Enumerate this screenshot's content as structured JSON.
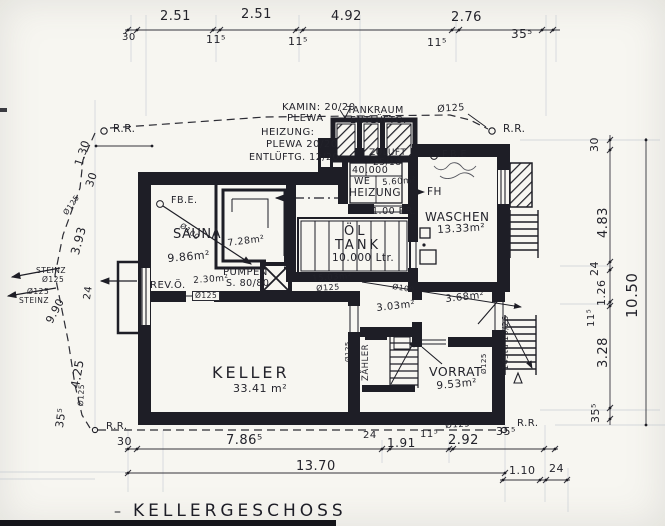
{
  "title": {
    "text": "KELLERGESCHOSS"
  },
  "annotations": [
    {
      "n": "dim-top-30",
      "t": "30",
      "x": 122,
      "y": 33,
      "s": 10
    },
    {
      "n": "dim-top-251-a",
      "t": "2.51",
      "x": 160,
      "y": 10,
      "s": 13
    },
    {
      "n": "dim-top-115-a",
      "t": "11⁵",
      "x": 206,
      "y": 34,
      "s": 11
    },
    {
      "n": "dim-top-251-b",
      "t": "2.51",
      "x": 241,
      "y": 8,
      "s": 13
    },
    {
      "n": "dim-top-115-b",
      "t": "11⁵",
      "x": 288,
      "y": 36,
      "s": 11
    },
    {
      "n": "dim-top-492",
      "t": "4.92",
      "x": 331,
      "y": 10,
      "s": 13
    },
    {
      "n": "dim-top-115-c",
      "t": "11⁵",
      "x": 427,
      "y": 37,
      "s": 11
    },
    {
      "n": "dim-top-276",
      "t": "2.76",
      "x": 451,
      "y": 11,
      "s": 13
    },
    {
      "n": "dim-top-355",
      "t": "35⁵",
      "x": 511,
      "y": 28,
      "s": 12
    },
    {
      "n": "rr-top-left",
      "t": "R.R.",
      "x": 113,
      "y": 124,
      "s": 10.5
    },
    {
      "n": "label-kamin",
      "t": "KAMIN: 20/20",
      "x": 282,
      "y": 103,
      "s": 10
    },
    {
      "n": "label-kamin-plewa",
      "t": "PLEWA",
      "x": 287,
      "y": 114,
      "s": 10
    },
    {
      "n": "label-heizung-schacht",
      "t": "HEIZUNG:",
      "x": 261,
      "y": 128,
      "s": 10
    },
    {
      "n": "label-heizung-plewa",
      "t": "PLEWA 20/20",
      "x": 266,
      "y": 140,
      "s": 10
    },
    {
      "n": "label-entlueftg",
      "t": "ENTLÜFTG. 12/20",
      "x": 249,
      "y": 153,
      "s": 9.5
    },
    {
      "n": "label-tankraum",
      "t": "TANKRAUM",
      "x": 347,
      "y": 106,
      "s": 9.5
    },
    {
      "n": "label-tankraum-entlueftg",
      "t": "ENTLÜFTG.",
      "x": 350,
      "y": 116,
      "s": 9.5
    },
    {
      "n": "label-o125-top",
      "t": "Ø125",
      "x": 437,
      "y": 105,
      "s": 9.5,
      "r": -4
    },
    {
      "n": "rr-top-right",
      "t": "R.R.",
      "x": 503,
      "y": 124,
      "s": 10.5
    },
    {
      "n": "label-zuluft",
      "t": "ZULUFT",
      "x": 369,
      "y": 149,
      "s": 9
    },
    {
      "n": "label-zuluft-size",
      "t": "25/18",
      "x": 373,
      "y": 159,
      "s": 9
    },
    {
      "n": "label-boiler-40000",
      "t": "40.000",
      "x": 352,
      "y": 166,
      "s": 9.5
    },
    {
      "n": "label-boiler-we",
      "t": "WE",
      "x": 354,
      "y": 177,
      "s": 9.5
    },
    {
      "n": "room-heizung",
      "t": "HEIZUNG",
      "x": 349,
      "y": 188,
      "s": 10.5
    },
    {
      "n": "area-heizung",
      "t": "5.60m²",
      "x": 382,
      "y": 179,
      "s": 8.5,
      "r": -4
    },
    {
      "n": "label-fh",
      "t": "FH",
      "x": 427,
      "y": 187,
      "s": 10.5
    },
    {
      "n": "label-door-100",
      "t": "1.00 BR.",
      "x": 372,
      "y": 207,
      "s": 9.5
    },
    {
      "n": "room-waschen",
      "t": "WASCHEN",
      "x": 425,
      "y": 211,
      "s": 12
    },
    {
      "n": "area-waschen",
      "t": "13.33m²",
      "x": 437,
      "y": 225,
      "s": 10.5,
      "r": -3
    },
    {
      "n": "label-fbe-waschen",
      "t": "F.B.E",
      "x": 442,
      "y": 150,
      "s": 9.5
    },
    {
      "n": "label-fbe-sauna",
      "t": "FB.E.",
      "x": 171,
      "y": 196,
      "s": 9.5
    },
    {
      "n": "label-o100-sauna",
      "t": "Ø100",
      "x": 183,
      "y": 222,
      "s": 7.5,
      "r": 37
    },
    {
      "n": "room-sauna",
      "t": "SAUNA",
      "x": 173,
      "y": 228,
      "s": 13
    },
    {
      "n": "area-sauna",
      "t": "9.86m²",
      "x": 167,
      "y": 253,
      "s": 11,
      "r": -5
    },
    {
      "n": "area-sauna-kabine",
      "t": "7.28m²",
      "x": 227,
      "y": 239,
      "s": 9.5,
      "r": -7
    },
    {
      "n": "room-pumpen",
      "t": "PUMPEN",
      "x": 223,
      "y": 268,
      "s": 10
    },
    {
      "n": "label-revoe",
      "t": "REV.Ö.",
      "x": 150,
      "y": 281,
      "s": 10
    },
    {
      "n": "area-corridor",
      "t": "2.30m²",
      "x": 193,
      "y": 277,
      "s": 9,
      "r": -4
    },
    {
      "n": "label-schacht",
      "t": "S. 80/80",
      "x": 226,
      "y": 279,
      "s": 9.5
    },
    {
      "n": "label-o125-corridor",
      "t": "Ø125",
      "x": 192,
      "y": 291,
      "s": 7.5,
      "c": "box"
    },
    {
      "n": "room-oel",
      "t": "ÖL",
      "x": 344,
      "y": 225,
      "s": 13,
      "c": "sp"
    },
    {
      "n": "room-tank",
      "t": "TANK",
      "x": 335,
      "y": 239,
      "s": 13,
      "c": "sp"
    },
    {
      "n": "label-tank-litres",
      "t": "10.000 Ltr.",
      "x": 332,
      "y": 253,
      "s": 10.5
    },
    {
      "n": "area-tank",
      "t": "15.03m²",
      "x": 312,
      "y": 275,
      "s": 8.5,
      "r": -4
    },
    {
      "n": "label-o125-tank",
      "t": "Ø125",
      "x": 316,
      "y": 285,
      "s": 8,
      "r": -4
    },
    {
      "n": "room-keller",
      "t": "KELLER",
      "x": 212,
      "y": 365,
      "s": 16,
      "c": "sp"
    },
    {
      "n": "area-keller",
      "t": "33.41 m²",
      "x": 233,
      "y": 383,
      "s": 11
    },
    {
      "n": "area-303",
      "t": "3.03m²",
      "x": 376,
      "y": 304,
      "s": 10,
      "r": -6
    },
    {
      "n": "area-368",
      "t": "3.68m²",
      "x": 445,
      "y": 295,
      "s": 10,
      "r": -6
    },
    {
      "n": "label-o100-drain",
      "t": "Ø100",
      "x": 393,
      "y": 283,
      "s": 7.5,
      "r": 9
    },
    {
      "n": "label-zaehler",
      "t": "ZÄHLER",
      "x": 362,
      "y": 381,
      "s": 8.5,
      "r": -90
    },
    {
      "n": "room-vorrat",
      "t": "VORRAT",
      "x": 429,
      "y": 366,
      "s": 12.5
    },
    {
      "n": "area-vorrat",
      "t": "9.53m²",
      "x": 436,
      "y": 381,
      "s": 10.5,
      "r": -5
    },
    {
      "n": "label-stair-ext",
      "t": "14Std 19/26",
      "x": 502,
      "y": 370,
      "s": 8,
      "r": -90
    },
    {
      "n": "label-o125-v1",
      "t": "Ø125",
      "x": 345,
      "y": 362,
      "s": 7,
      "r": -90
    },
    {
      "n": "label-o125-v2",
      "t": "Ø125",
      "x": 481,
      "y": 374,
      "s": 7,
      "r": -90
    },
    {
      "n": "dim-right-30",
      "t": "30",
      "x": 589,
      "y": 152,
      "s": 11,
      "r": -90
    },
    {
      "n": "dim-right-483",
      "t": "4.83",
      "x": 597,
      "y": 238,
      "s": 13,
      "r": -90
    },
    {
      "n": "dim-right-24",
      "t": "24",
      "x": 589,
      "y": 276,
      "s": 11,
      "r": -90
    },
    {
      "n": "dim-right-126",
      "t": "1.26",
      "x": 596,
      "y": 306,
      "s": 11,
      "r": -90
    },
    {
      "n": "dim-right-115",
      "t": "11⁵",
      "x": 587,
      "y": 327,
      "s": 10,
      "r": -90
    },
    {
      "n": "dim-right-328",
      "t": "3.28",
      "x": 597,
      "y": 368,
      "s": 13,
      "r": -90
    },
    {
      "n": "dim-right-355",
      "t": "35⁵",
      "x": 590,
      "y": 423,
      "s": 11,
      "r": -90
    },
    {
      "n": "dim-right-1050",
      "t": "10.50",
      "x": 625,
      "y": 318,
      "s": 15,
      "r": -90
    },
    {
      "n": "dim-left-130",
      "t": "1.30",
      "x": 73,
      "y": 164,
      "s": 11,
      "r": -72
    },
    {
      "n": "dim-left-30",
      "t": "30",
      "x": 84,
      "y": 185,
      "s": 11,
      "r": -72
    },
    {
      "n": "dim-left-o125",
      "t": "Ø125",
      "x": 62,
      "y": 212,
      "s": 7.5,
      "r": -55
    },
    {
      "n": "dim-left-393",
      "t": "3.93",
      "x": 69,
      "y": 253,
      "s": 12,
      "r": -75
    },
    {
      "n": "dim-left-24",
      "t": "24",
      "x": 83,
      "y": 299,
      "s": 10,
      "r": -82
    },
    {
      "n": "dim-left-990",
      "t": "9.90",
      "x": 44,
      "y": 320,
      "s": 11,
      "r": -62
    },
    {
      "n": "dim-left-425",
      "t": "4.25",
      "x": 69,
      "y": 387,
      "s": 12,
      "r": -80
    },
    {
      "n": "dim-left-o126",
      "t": "Ø125",
      "x": 77,
      "y": 406,
      "s": 7.5,
      "r": -87
    },
    {
      "n": "dim-left-355",
      "t": "35⁵",
      "x": 54,
      "y": 427,
      "s": 11,
      "r": -82
    },
    {
      "n": "label-steinz-1",
      "t": "STEINZ",
      "x": 36,
      "y": 267,
      "s": 7.5
    },
    {
      "n": "label-steinz-1d",
      "t": "Ø125",
      "x": 42,
      "y": 276,
      "s": 7.5
    },
    {
      "n": "label-steinz-2d",
      "t": "Ø125",
      "x": 27,
      "y": 288,
      "s": 7.5
    },
    {
      "n": "label-steinz-2",
      "t": "STEINZ",
      "x": 19,
      "y": 297,
      "s": 7.5
    },
    {
      "n": "rr-bottom-left",
      "t": "R.R.",
      "x": 106,
      "y": 422,
      "s": 10
    },
    {
      "n": "dim-bot-30",
      "t": "30",
      "x": 117,
      "y": 436,
      "s": 11
    },
    {
      "n": "dim-bot-7865",
      "t": "7.86⁵",
      "x": 226,
      "y": 434,
      "s": 13
    },
    {
      "n": "dim-bot-24",
      "t": "24",
      "x": 363,
      "y": 431,
      "s": 10
    },
    {
      "n": "dim-bot-191",
      "t": "1.91",
      "x": 387,
      "y": 437,
      "s": 12
    },
    {
      "n": "dim-bot-115",
      "t": "11⁵",
      "x": 420,
      "y": 430,
      "s": 10
    },
    {
      "n": "dim-bot-292",
      "t": "2.92",
      "x": 448,
      "y": 434,
      "s": 13
    },
    {
      "n": "dim-bot-o125",
      "t": "Ø125",
      "x": 445,
      "y": 422,
      "s": 8.5,
      "r": -4
    },
    {
      "n": "dim-bot-355",
      "t": "35⁵",
      "x": 496,
      "y": 426,
      "s": 11
    },
    {
      "n": "rr-bottom-right",
      "t": "R.R.",
      "x": 517,
      "y": 419,
      "s": 10
    },
    {
      "n": "dim-bot-1370",
      "t": "13.70",
      "x": 296,
      "y": 460,
      "s": 13
    },
    {
      "n": "dim-bot-110",
      "t": "1.10",
      "x": 509,
      "y": 465,
      "s": 11
    },
    {
      "n": "dim-bot-24b",
      "t": "24",
      "x": 549,
      "y": 463,
      "s": 11
    },
    {
      "n": "title-dash",
      "t": "–",
      "x": 114,
      "y": 505,
      "s": 14
    }
  ]
}
